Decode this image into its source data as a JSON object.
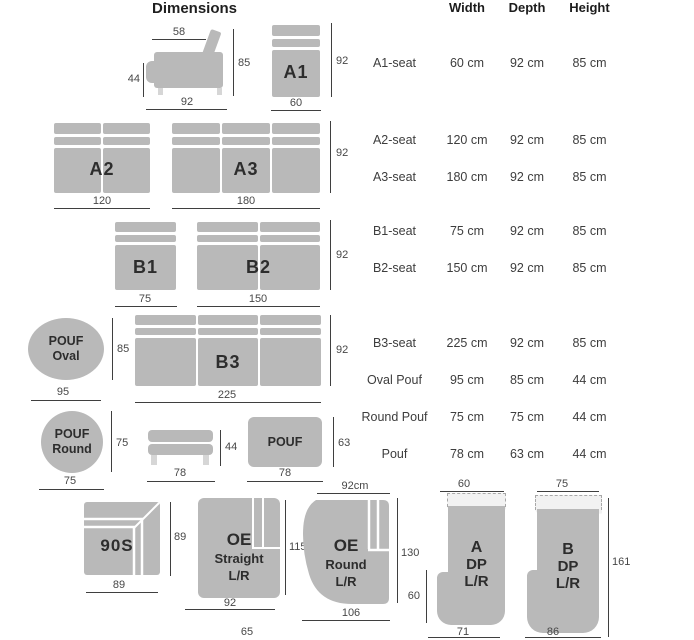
{
  "title": "Dimensions",
  "table": {
    "headers": [
      "Width",
      "Depth",
      "Height"
    ],
    "rows": [
      {
        "label": "A1-seat",
        "width": "60 cm",
        "depth": "92 cm",
        "height": "85 cm"
      },
      {
        "label": "A2-seat",
        "width": "120 cm",
        "depth": "92 cm",
        "height": "85 cm"
      },
      {
        "label": "A3-seat",
        "width": "180 cm",
        "depth": "92 cm",
        "height": "85 cm"
      },
      {
        "label": "B1-seat",
        "width": "75 cm",
        "depth": "92 cm",
        "height": "85 cm"
      },
      {
        "label": "B2-seat",
        "width": "150 cm",
        "depth": "92 cm",
        "height": "85 cm"
      },
      {
        "label": "B3-seat",
        "width": "225 cm",
        "depth": "92 cm",
        "height": "85 cm"
      },
      {
        "label": "Oval Pouf",
        "width": "95 cm",
        "depth": "85 cm",
        "height": "44 cm"
      },
      {
        "label": "Round Pouf",
        "width": "75 cm",
        "depth": "75 cm",
        "height": "44 cm"
      },
      {
        "label": "Pouf",
        "width": "78 cm",
        "depth": "63 cm",
        "height": "44 cm"
      }
    ]
  },
  "colors": {
    "shape": "#b9b9b9",
    "line": "#3f3f3f",
    "scallop": "#f2f2f2"
  },
  "diagrams": {
    "side_view": {
      "seat_depth": "58",
      "seat_height": "44",
      "height": "85",
      "depth": "92"
    },
    "a1": {
      "label": "A1",
      "depth": "92",
      "width": "60"
    },
    "a2": {
      "label": "A2",
      "width": "120"
    },
    "a3": {
      "label": "A3",
      "width": "180",
      "depth": "92"
    },
    "b1": {
      "label": "B1",
      "width": "75"
    },
    "b2": {
      "label": "B2",
      "width": "150",
      "depth": "92"
    },
    "b3": {
      "label": "B3",
      "width": "225",
      "depth": "92"
    },
    "pouf_oval": {
      "line1": "POUF",
      "line2": "Oval",
      "width": "95",
      "depth": "85"
    },
    "pouf_round": {
      "line1": "POUF",
      "line2": "Round",
      "width": "75",
      "depth": "75"
    },
    "pouf_side": {
      "width": "78",
      "height": "44"
    },
    "pouf": {
      "label": "POUF",
      "width": "78",
      "depth": "63"
    },
    "s90": {
      "label": "90S",
      "width": "89",
      "depth": "89"
    },
    "oe_straight": {
      "line1": "OE",
      "line2": "Straight",
      "line3": "L/R",
      "width": "92",
      "depth": "115",
      "base": "65"
    },
    "oe_round": {
      "line1": "OE",
      "line2": "Round",
      "line3": "L/R",
      "top_width": "92cm",
      "bottom_width": "106",
      "depth": "130"
    },
    "a_dp": {
      "line1": "A",
      "line2": "DP",
      "line3": "L/R",
      "top_width": "60",
      "bottom_width": "71",
      "notch_height": "60"
    },
    "b_dp": {
      "line1": "B",
      "line2": "DP",
      "line3": "L/R",
      "top_width": "75",
      "bottom_width": "86",
      "height": "161"
    }
  }
}
